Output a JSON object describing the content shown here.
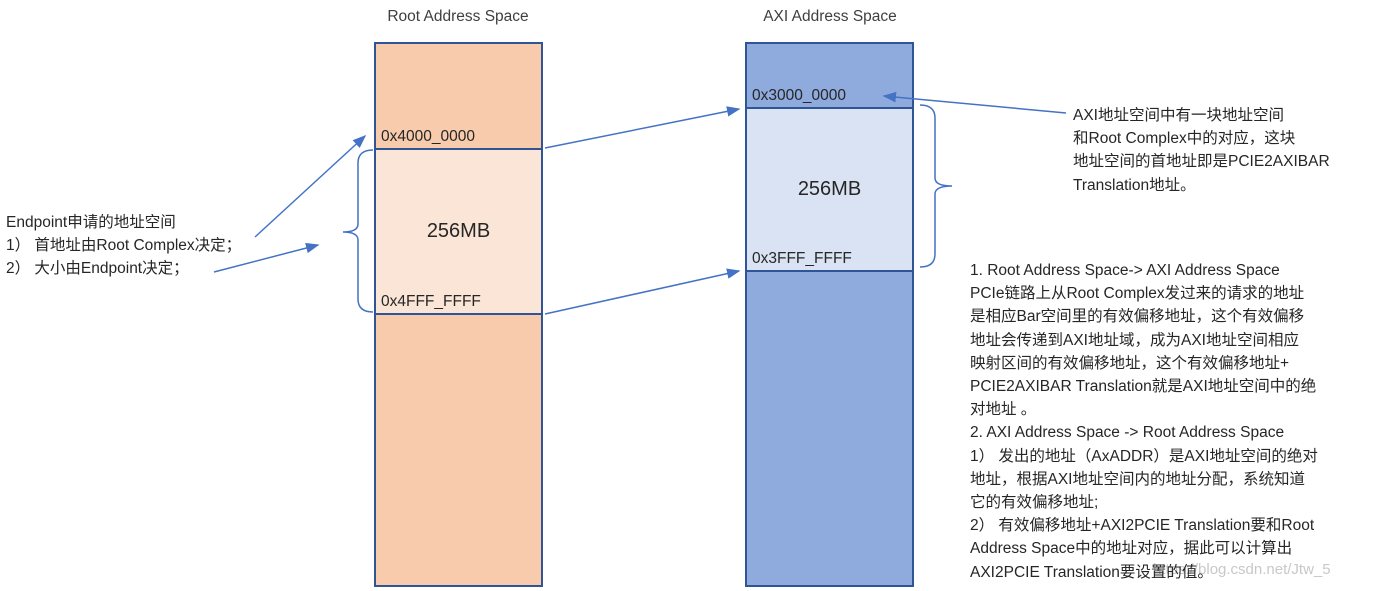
{
  "colors": {
    "border": "#2F5597",
    "arrow": "#4472C4",
    "root_upper": "#F8CBAD",
    "root_mapped": "#FBE5D6",
    "axi_upper": "#8FAADC",
    "axi_mapped": "#DAE3F3",
    "text": "#2B2B2B",
    "muted": "#3F3F3F",
    "watermark": "#C8C8C8"
  },
  "root_space": {
    "title": "Root Address Space",
    "region_start": "0x4000_0000",
    "region_size": "256MB",
    "region_end": "0x4FFF_FFFF"
  },
  "axi_space": {
    "title": "AXI Address Space",
    "region_start": "0x3000_0000",
    "region_size": "256MB",
    "region_end": "0x3FFF_FFFF"
  },
  "endpoint_note": {
    "lines": [
      "Endpoint申请的地址空间",
      "1） 首地址由Root Complex决定；",
      "2） 大小由Endpoint决定；"
    ]
  },
  "axibar_note": {
    "lines": [
      "AXI地址空间中有一块地址空间",
      "和Root Complex中的对应，这块",
      "地址空间的首地址即是PCIE2AXIBAR",
      "Translation地址。"
    ]
  },
  "translation_note": {
    "lines": [
      "1. Root Address Space-> AXI Address Space",
      "PCIe链路上从Root Complex发过来的请求的地址",
      "是相应Bar空间里的有效偏移地址，这个有效偏移",
      "地址会传递到AXI地址域，成为AXI地址空间相应",
      "映射区间的有效偏移地址，这个有效偏移地址+",
      "PCIE2AXIBAR Translation就是AXI地址空间中的绝",
      "对地址 。",
      "2. AXI Address Space -> Root Address Space",
      "1） 发出的地址（AxADDR）是AXI地址空间的绝对",
      "地址，根据AXI地址空间内的地址分配，系统知道",
      "它的有效偏移地址;",
      "2） 有效偏移地址+AXI2PCIE Translation要和Root",
      "Address Space中的地址对应，据此可以计算出",
      "AXI2PCIE Translation要设置的值。"
    ]
  },
  "watermark": "https://blog.csdn.net/Jtw_5"
}
